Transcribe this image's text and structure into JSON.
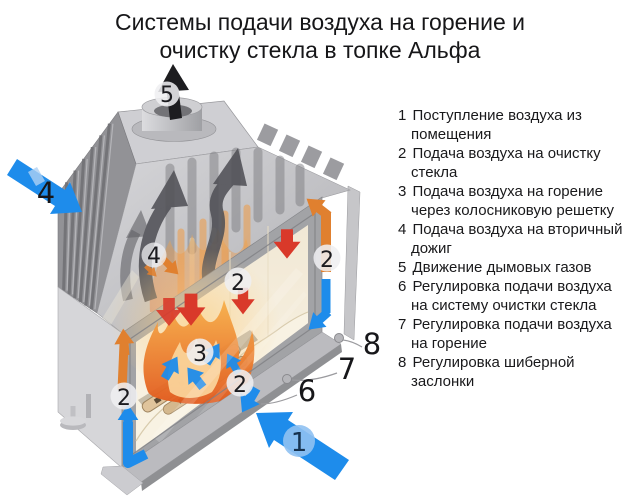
{
  "title": {
    "line1": "Системы подачи воздуха на горение и",
    "line2": "очистку стекла в топке Альфа"
  },
  "legend": {
    "items": [
      {
        "num": "1",
        "text": "Поступление воздуха из помещения"
      },
      {
        "num": "2",
        "text": "Подача воздуха на очистку стекла"
      },
      {
        "num": "3",
        "text": "Подача воздуха на горение через колосниковую решетку"
      },
      {
        "num": "4",
        "text": "Подача воздуха на вторичный дожиг"
      },
      {
        "num": "5",
        "text": "Движение дымовых газов"
      },
      {
        "num": "6",
        "text": "Регулировка подачи воздуха на систему очистки стекла"
      },
      {
        "num": "7",
        "text": "Регулировка подачи воздуха на горение"
      },
      {
        "num": "8",
        "text": "Регулировка шиберной заслонки"
      }
    ]
  },
  "diagram": {
    "callouts": {
      "n1": "1",
      "n2": "2",
      "n3": "3",
      "n4": "4",
      "n5": "5",
      "n6": "6",
      "n7": "7",
      "n8": "8"
    },
    "colors": {
      "intake_blue": "#1e8ceb",
      "heated_air_orange": "#e0802f",
      "glass_wash_red": "#d9392a",
      "flue_black": "#1d1d20",
      "smoke_gray": "#515157"
    }
  }
}
